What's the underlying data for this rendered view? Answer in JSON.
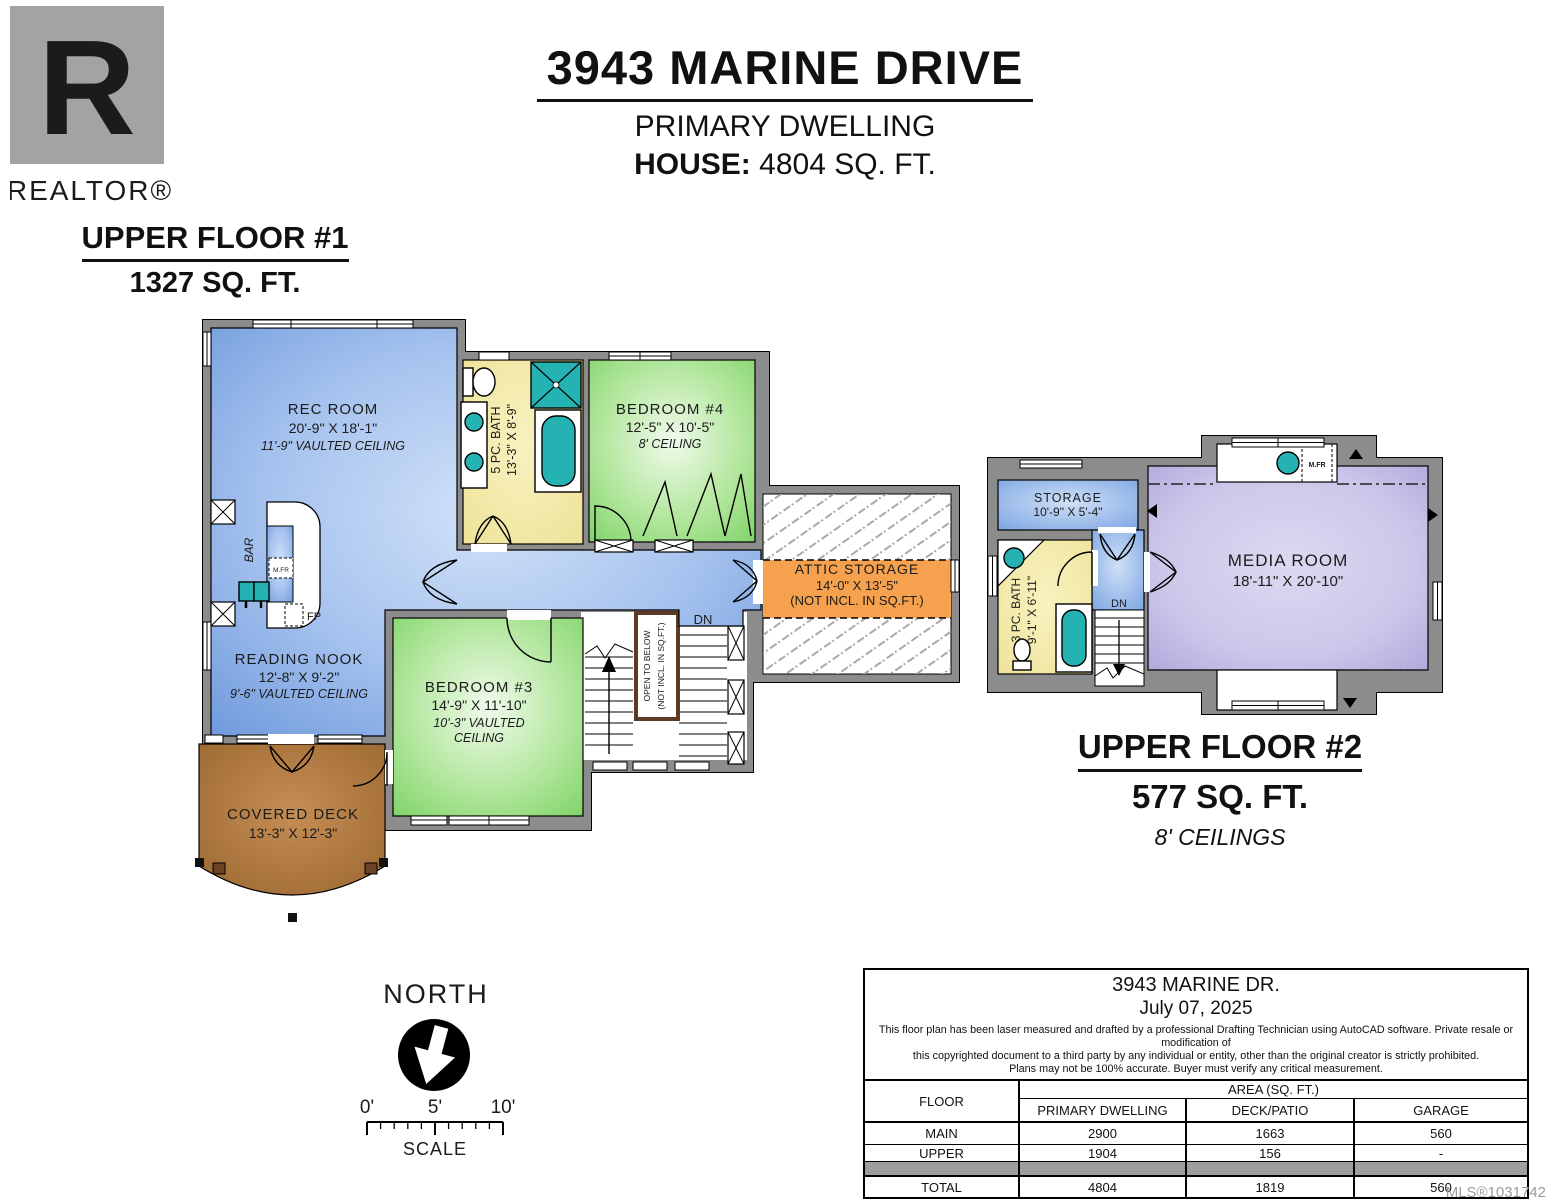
{
  "logo": {
    "letter": "R",
    "label": "REALTOR®"
  },
  "header": {
    "address": "3943 MARINE DRIVE",
    "dwelling": "PRIMARY DWELLING",
    "house_label": "HOUSE:",
    "house_value": "4804 SQ. FT."
  },
  "floor1": {
    "title": "UPPER FLOOR #1",
    "area": "1327 SQ. FT.",
    "rec_room_name": "REC ROOM",
    "rec_room_dims": "20'-9\" X 18'-1\"",
    "rec_room_ceiling": "11'-9\" VAULTED CEILING",
    "bath_name": "5 PC. BATH",
    "bath_dims": "13'-3\" X 8'-9\"",
    "bedroom4_name": "BEDROOM #4",
    "bedroom4_dims": "12'-5\" X 10'-5\"",
    "bedroom4_ceiling": "8' CEILING",
    "attic_name": "ATTIC STORAGE",
    "attic_dims": "14'-0\" X 13'-5\"",
    "attic_note": "(NOT INCL. IN SQ.FT.)",
    "nook_name": "READING NOOK",
    "nook_dims": "12'-8\" X 9'-2\"",
    "nook_ceiling": "9'-6\" VAULTED CEILING",
    "bedroom3_name": "BEDROOM #3",
    "bedroom3_dims": "14'-9\" X 11'-10\"",
    "bedroom3_ceiling1": "10'-3\" VAULTED",
    "bedroom3_ceiling2": "CEILING",
    "deck_name": "COVERED DECK",
    "deck_dims": "13'-3\" X 12'-3\"",
    "bar": "BAR",
    "mfr": "M.FR",
    "fp": "FP",
    "dn": "DN",
    "open_below_1": "OPEN TO BELOW",
    "open_below_2": "(NOT INCL. IN SQ.FT.)"
  },
  "floor2": {
    "title": "UPPER FLOOR #2",
    "area": "577 SQ. FT.",
    "ceilings": "8' CEILINGS",
    "storage_name": "STORAGE",
    "storage_dims": "10'-9\" X 5'-4\"",
    "bath_name": "3 PC. BATH",
    "bath_dims": "9'-1\" X 6'-11\"",
    "media_name": "MEDIA ROOM",
    "media_dims": "18'-11\" X 20'-10\"",
    "mfr": "M.FR",
    "dn": "DN"
  },
  "compass": {
    "label": "NORTH"
  },
  "scalebar": {
    "t0": "0'",
    "t5": "5'",
    "t10": "10'",
    "label": "SCALE"
  },
  "area_table": {
    "title": "3943 MARINE DR.",
    "date": "July 07, 2025",
    "disclaimer1": "This floor plan has been laser measured and drafted by a professional Drafting Technician using AutoCAD software. Private resale or modification of",
    "disclaimer2": "this copyrighted document to a third party by any individual or entity, other than the original creator is strictly prohibited.",
    "disclaimer3": "Plans may not be 100% accurate.  Buyer must verify any critical measurement.",
    "floor_header": "FLOOR",
    "area_header": "AREA (SQ. FT.)",
    "col1": "PRIMARY DWELLING",
    "col2": "DECK/PATIO",
    "col3": "GARAGE",
    "rows": [
      {
        "floor": "MAIN",
        "c1": "2900",
        "c2": "1663",
        "c3": "560"
      },
      {
        "floor": "UPPER",
        "c1": "1904",
        "c2": "156",
        "c3": "-"
      },
      {
        "floor": "TOTAL",
        "c1": "4804",
        "c2": "1819",
        "c3": "560"
      }
    ]
  },
  "footer": {
    "mls": "MLS®1031742"
  },
  "colors": {
    "room_blue": "#6e99dc",
    "room_green": "#7fd468",
    "room_yellow": "#efe49a",
    "room_lavender": "#b0a5da",
    "deck_brown": "#a86f38",
    "attic_orange": "#f5a14d",
    "fixture_teal": "#25b2b2",
    "wall_gray": "#8c8c8c"
  }
}
